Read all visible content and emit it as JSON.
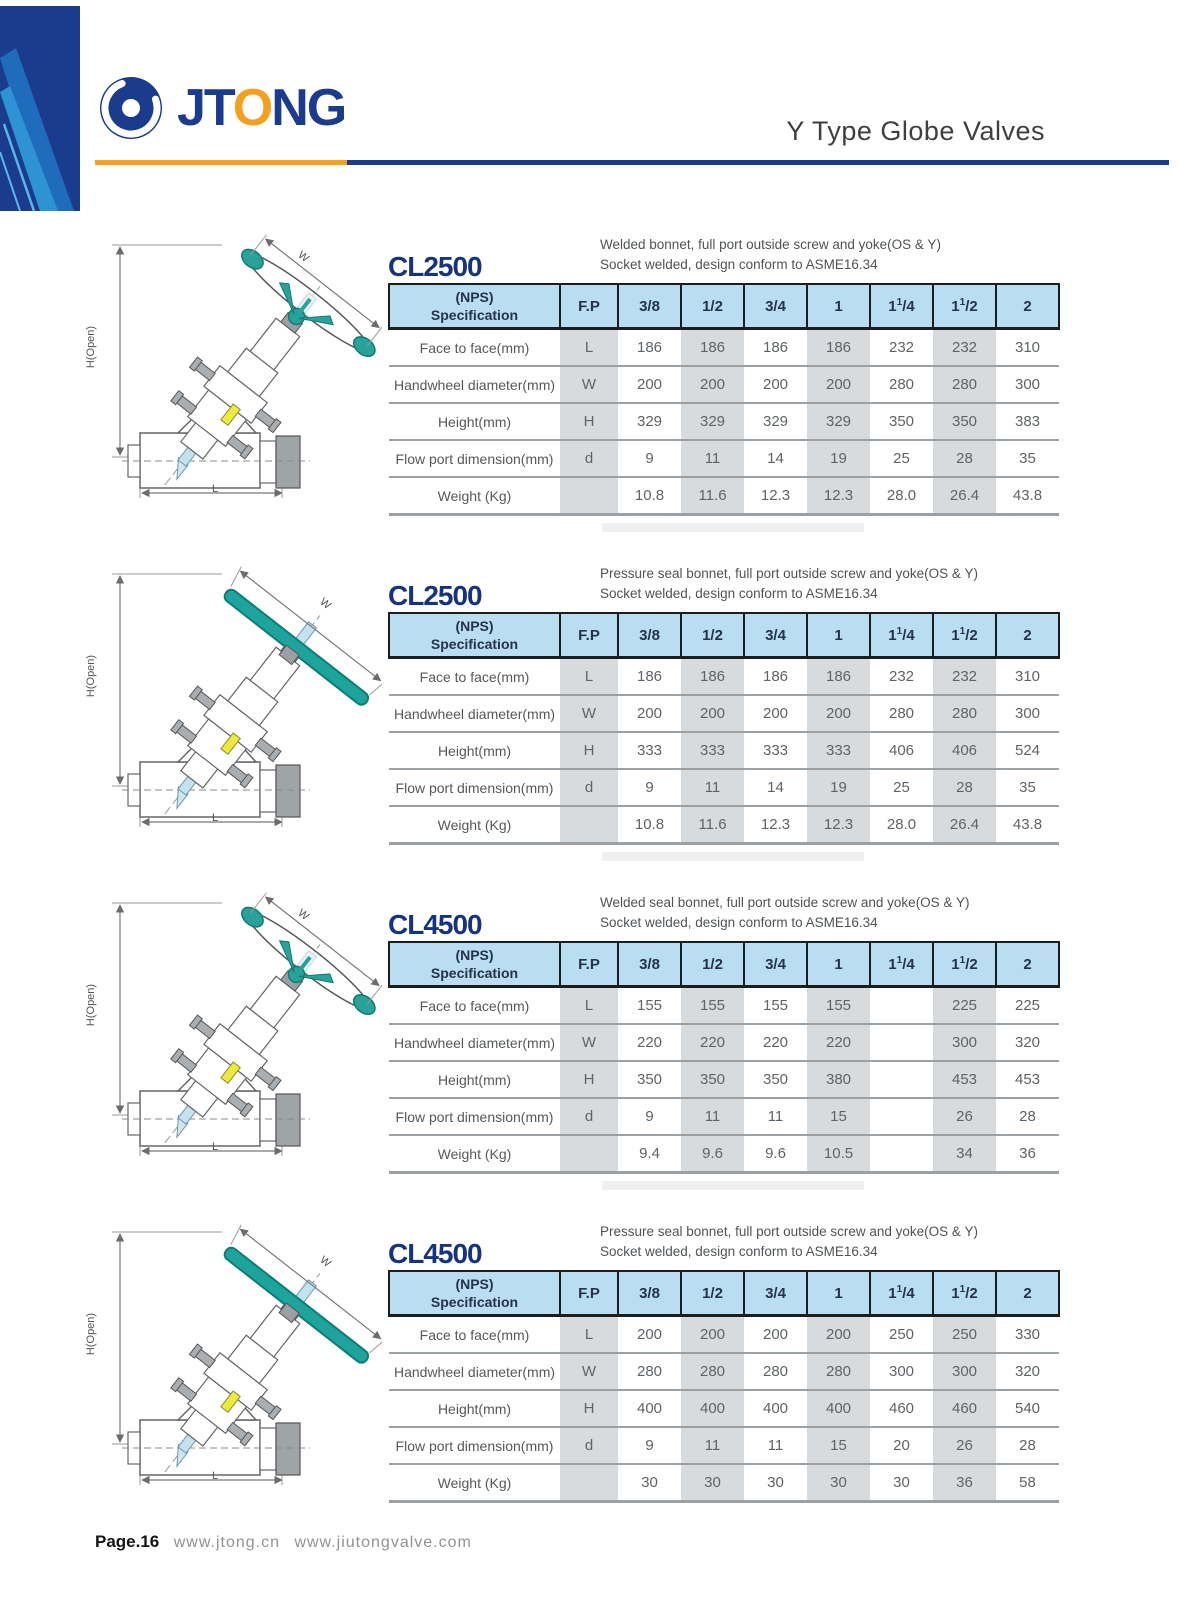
{
  "brand": {
    "pre": "JT",
    "o": "O",
    "post": "NG"
  },
  "header": {
    "title": "Y Type Globe Valves"
  },
  "drawing_labels": {
    "height": "H(Open)",
    "width": "W",
    "length": "L"
  },
  "colors": {
    "navy": "#1b3b8c",
    "orange": "#f6a01d",
    "header_blue": "#b9ddf1",
    "column_gray": "#d8dbdd",
    "teal": "#29a29a"
  },
  "tables": [
    {
      "model": "CL2500",
      "desc1": "Welded bonnet, full port outside screw and yoke(OS & Y)",
      "desc2": "Socket welded, design conform to ASME16.34",
      "variant": "handwheel",
      "columns": {
        "spec1": "(NPS)",
        "spec2": "Specification",
        "fp": "F.P",
        "sizes": [
          "3/8",
          "1/2",
          "3/4",
          "1",
          "1 1/4",
          "1 1/2",
          "2"
        ]
      },
      "rows": [
        {
          "label": "Face to face(mm)",
          "fp": "L",
          "values": [
            "186",
            "186",
            "186",
            "186",
            "232",
            "232",
            "310"
          ]
        },
        {
          "label": "Handwheel diameter(mm)",
          "fp": "W",
          "values": [
            "200",
            "200",
            "200",
            "200",
            "280",
            "280",
            "300"
          ]
        },
        {
          "label": "Height(mm)",
          "fp": "H",
          "values": [
            "329",
            "329",
            "329",
            "329",
            "350",
            "350",
            "383"
          ]
        },
        {
          "label": "Flow port dimension(mm)",
          "fp": "d",
          "values": [
            "9",
            "11",
            "14",
            "19",
            "25",
            "28",
            "35"
          ]
        },
        {
          "label": "Weight (Kg)",
          "fp": "",
          "values": [
            "10.8",
            "11.6",
            "12.3",
            "12.3",
            "28.0",
            "26.4",
            "43.8"
          ]
        }
      ]
    },
    {
      "model": "CL2500",
      "desc1": "Pressure seal bonnet, full port outside screw and yoke(OS & Y)",
      "desc2": "Socket welded, design conform to ASME16.34",
      "variant": "tbar",
      "columns": {
        "spec1": "(NPS)",
        "spec2": "Specification",
        "fp": "F.P",
        "sizes": [
          "3/8",
          "1/2",
          "3/4",
          "1",
          "1 1/4",
          "1 1/2",
          "2"
        ]
      },
      "rows": [
        {
          "label": "Face to face(mm)",
          "fp": "L",
          "values": [
            "186",
            "186",
            "186",
            "186",
            "232",
            "232",
            "310"
          ]
        },
        {
          "label": "Handwheel diameter(mm)",
          "fp": "W",
          "values": [
            "200",
            "200",
            "200",
            "200",
            "280",
            "280",
            "300"
          ]
        },
        {
          "label": "Height(mm)",
          "fp": "H",
          "values": [
            "333",
            "333",
            "333",
            "333",
            "406",
            "406",
            "524"
          ]
        },
        {
          "label": "Flow port dimension(mm)",
          "fp": "d",
          "values": [
            "9",
            "11",
            "14",
            "19",
            "25",
            "28",
            "35"
          ]
        },
        {
          "label": "Weight (Kg)",
          "fp": "",
          "values": [
            "10.8",
            "11.6",
            "12.3",
            "12.3",
            "28.0",
            "26.4",
            "43.8"
          ]
        }
      ]
    },
    {
      "model": "CL4500",
      "desc1": "Welded seal bonnet,  full port outside screw and yoke(OS & Y)",
      "desc2": "Socket welded, design conform to ASME16.34",
      "variant": "handwheel",
      "columns": {
        "spec1": "(NPS)",
        "spec2": "Specification",
        "fp": "F.P",
        "sizes": [
          "3/8",
          "1/2",
          "3/4",
          "1",
          "1 1/4",
          "1 1/2",
          "2"
        ]
      },
      "rows": [
        {
          "label": "Face to face(mm)",
          "fp": "L",
          "values": [
            "155",
            "155",
            "155",
            "155",
            "",
            "225",
            "225"
          ]
        },
        {
          "label": "Handwheel diameter(mm)",
          "fp": "W",
          "values": [
            "220",
            "220",
            "220",
            "220",
            "",
            "300",
            "320"
          ]
        },
        {
          "label": "Height(mm)",
          "fp": "H",
          "values": [
            "350",
            "350",
            "350",
            "380",
            "",
            "453",
            "453"
          ]
        },
        {
          "label": "Flow port dimension(mm)",
          "fp": "d",
          "values": [
            "9",
            "11",
            "11",
            "15",
            "",
            "26",
            "28"
          ]
        },
        {
          "label": "Weight (Kg)",
          "fp": "",
          "values": [
            "9.4",
            "9.6",
            "9.6",
            "10.5",
            "",
            "34",
            "36"
          ]
        }
      ]
    },
    {
      "model": "CL4500",
      "desc1": "Pressure seal bonnet, full port outside screw and yoke(OS & Y)",
      "desc2": "Socket welded, design conform to ASME16.34",
      "variant": "tbar",
      "columns": {
        "spec1": "(NPS)",
        "spec2": "Specification",
        "fp": "F.P",
        "sizes": [
          "3/8",
          "1/2",
          "3/4",
          "1",
          "1 1/4",
          "1 1/2",
          "2"
        ]
      },
      "rows": [
        {
          "label": "Face to face(mm)",
          "fp": "L",
          "values": [
            "200",
            "200",
            "200",
            "200",
            "250",
            "250",
            "330"
          ]
        },
        {
          "label": "Handwheel diameter(mm)",
          "fp": "W",
          "values": [
            "280",
            "280",
            "280",
            "280",
            "300",
            "300",
            "320"
          ]
        },
        {
          "label": "Height(mm)",
          "fp": "H",
          "values": [
            "400",
            "400",
            "400",
            "400",
            "460",
            "460",
            "540"
          ]
        },
        {
          "label": "Flow port dimension(mm)",
          "fp": "d",
          "values": [
            "9",
            "11",
            "11",
            "15",
            "20",
            "26",
            "28"
          ]
        },
        {
          "label": "Weight (Kg)",
          "fp": "",
          "values": [
            "30",
            "30",
            "30",
            "30",
            "30",
            "36",
            "58"
          ]
        }
      ]
    }
  ],
  "footer": {
    "page_label": "Page.16",
    "url1": "www.jtong.cn",
    "url2": "www.jiutongvalve.com"
  }
}
